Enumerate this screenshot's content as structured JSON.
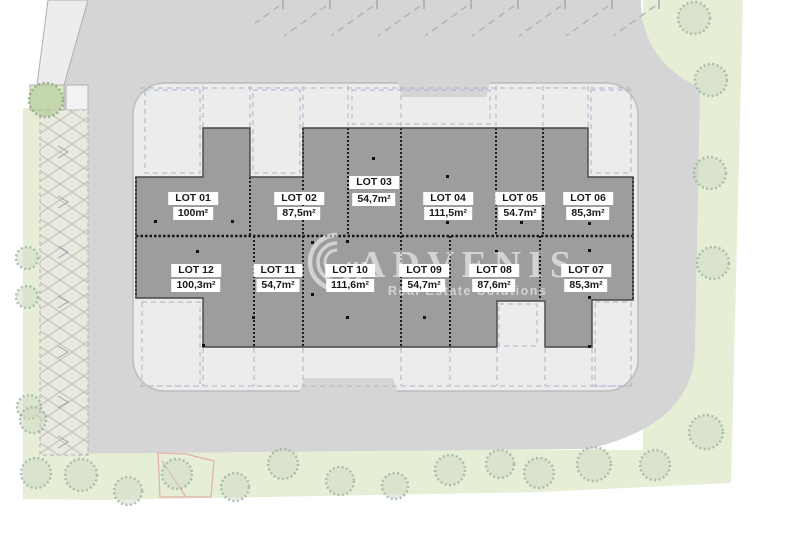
{
  "watermark": {
    "brand": "ADVENIS",
    "tagline": "Real Estate Solutions"
  },
  "lots": [
    {
      "id": "lot-01",
      "name": "LOT 01",
      "area": "100m²"
    },
    {
      "id": "lot-02",
      "name": "LOT 02",
      "area": "87,5m²"
    },
    {
      "id": "lot-03",
      "name": "LOT 03",
      "area": "54,7m²"
    },
    {
      "id": "lot-04",
      "name": "LOT 04",
      "area": "111,5m²"
    },
    {
      "id": "lot-05",
      "name": "LOT 05",
      "area": "54.7m²"
    },
    {
      "id": "lot-06",
      "name": "LOT 06",
      "area": "85,3m²"
    },
    {
      "id": "lot-07",
      "name": "LOT 07",
      "area": "85,3m²"
    },
    {
      "id": "lot-08",
      "name": "LOT 08",
      "area": "87,6m²"
    },
    {
      "id": "lot-09",
      "name": "LOT 09",
      "area": "54,7m²"
    },
    {
      "id": "lot-10",
      "name": "LOT 10",
      "area": "111,6m²"
    },
    {
      "id": "lot-11",
      "name": "LOT 11",
      "area": "54,7m²"
    },
    {
      "id": "lot-12",
      "name": "LOT 12",
      "area": "100,3m²"
    }
  ],
  "colors": {
    "background": "#ffffff",
    "road": "#d5d5d5",
    "platform": "#ececec",
    "platform_stroke": "#bcbcbc",
    "building": "#9d9d9d",
    "green": "#e6eed6",
    "green_square": "#dfe9cc",
    "hatch_fill": "#e9e9df",
    "wedge": "#ededed",
    "white_square": "#f2f2f2",
    "boundary_red": "#e09c9c"
  }
}
